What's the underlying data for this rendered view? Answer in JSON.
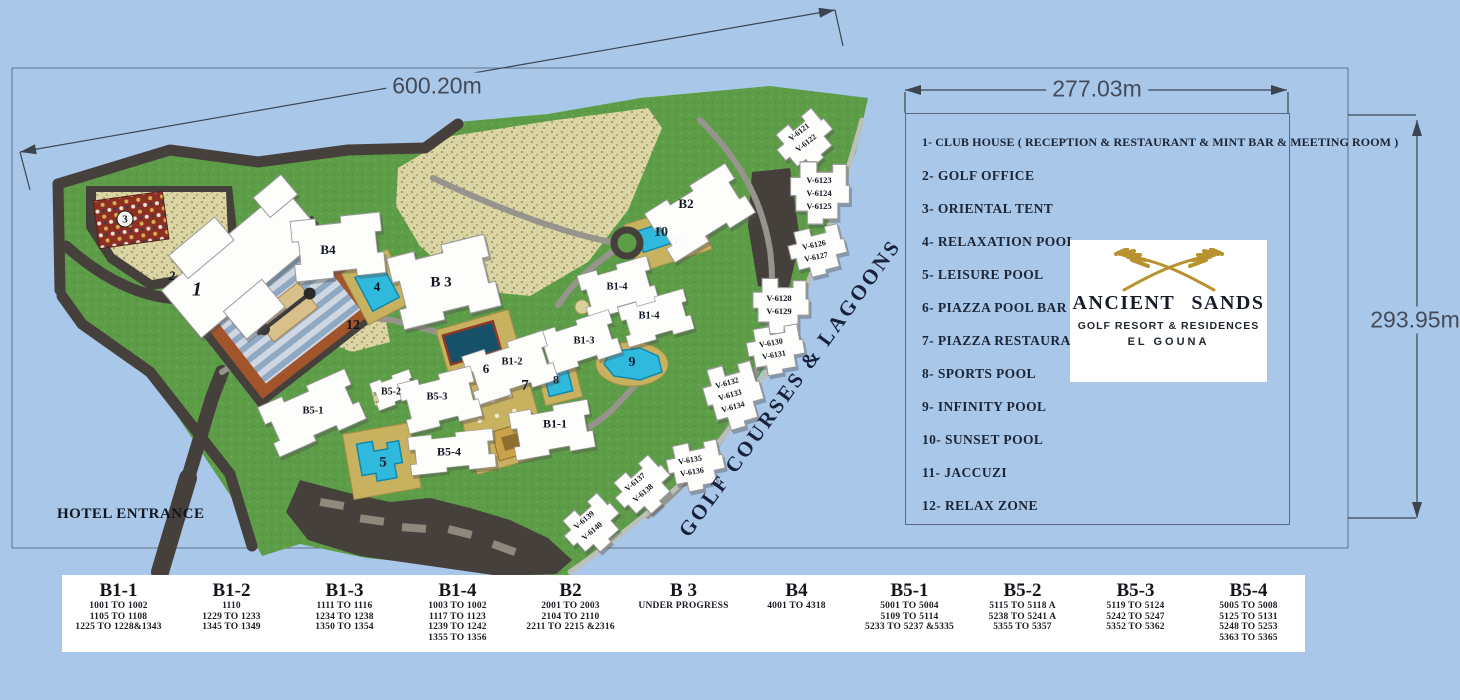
{
  "dimensions": {
    "top": "600.20m",
    "top_right": "277.03m",
    "right": "293.95m"
  },
  "legend": {
    "items": [
      "1- CLUB HOUSE  ( RECEPTION & RESTAURANT & MINT BAR & MEETING ROOM )",
      "2-  GOLF OFFICE",
      "3-  ORIENTAL TENT",
      "4-  RELAXATION POOL",
      "5-  LEISURE POOL",
      "6- PIAZZA POOL BAR",
      "7- PIAZZA RESTAURANT",
      "8- SPORTS POOL",
      "9- INFINITY POOL",
      "10- SUNSET POOL",
      "11- JACCUZI",
      "12- RELAX  ZONE"
    ]
  },
  "logo": {
    "name": "ANCIENT SANDS",
    "subtitle": "GOLF RESORT & RESIDENCES",
    "city": "EL GOUNA"
  },
  "map": {
    "entrance_label": "HOTEL ENTRANCE",
    "water_label": "GOLF COURSES & LAGOONS",
    "labels": [
      {
        "t": "1",
        "x": 197,
        "y": 290,
        "s": 20,
        "i": 1
      },
      {
        "t": "2",
        "x": 172,
        "y": 276,
        "s": 13,
        "i": 1
      },
      {
        "t": "3",
        "x": 125,
        "y": 219,
        "s": 11,
        "circ": 1
      },
      {
        "t": "B4",
        "x": 328,
        "y": 250,
        "s": 13
      },
      {
        "t": "4",
        "x": 377,
        "y": 287,
        "s": 13
      },
      {
        "t": "12",
        "x": 353,
        "y": 326,
        "s": 14
      },
      {
        "t": "B 3",
        "x": 441,
        "y": 283,
        "s": 15
      },
      {
        "t": "B2",
        "x": 686,
        "y": 204,
        "s": 13
      },
      {
        "t": "10",
        "x": 661,
        "y": 233,
        "s": 14,
        "c": "#0e2238"
      },
      {
        "t": "11",
        "x": 678,
        "y": 240,
        "s": 9,
        "c": "#eef6fa"
      },
      {
        "t": "B1-4",
        "x": 617,
        "y": 287,
        "s": 10.5
      },
      {
        "t": "B1-4",
        "x": 649,
        "y": 316,
        "s": 10.5
      },
      {
        "t": "B1-3",
        "x": 584,
        "y": 341,
        "s": 10.5
      },
      {
        "t": "B1-2",
        "x": 512,
        "y": 362,
        "s": 10.5
      },
      {
        "t": "6",
        "x": 486,
        "y": 369,
        "s": 13
      },
      {
        "t": "7",
        "x": 525,
        "y": 386,
        "s": 15
      },
      {
        "t": "8",
        "x": 556,
        "y": 380,
        "s": 12,
        "c": "#0e2238"
      },
      {
        "t": "9",
        "x": 632,
        "y": 363,
        "s": 14,
        "c": "#0e2238"
      },
      {
        "t": "B5-3",
        "x": 437,
        "y": 397,
        "s": 10.5
      },
      {
        "t": "B5-2",
        "x": 391,
        "y": 392,
        "s": 10
      },
      {
        "t": "B5-1",
        "x": 313,
        "y": 411,
        "s": 10.5
      },
      {
        "t": "B1-1",
        "x": 555,
        "y": 424,
        "s": 12
      },
      {
        "t": "B5-4",
        "x": 449,
        "y": 452,
        "s": 12
      },
      {
        "t": "5",
        "x": 383,
        "y": 463,
        "s": 15,
        "c": "#0e2238"
      },
      {
        "t": "V-6121",
        "x": 799,
        "y": 132,
        "s": 8,
        "r": -38
      },
      {
        "t": "V-6122",
        "x": 806,
        "y": 143,
        "s": 8,
        "r": -38
      },
      {
        "t": "V-6123",
        "x": 819,
        "y": 180,
        "s": 8.5
      },
      {
        "t": "V-6124",
        "x": 819,
        "y": 193,
        "s": 8.5
      },
      {
        "t": "V-6125",
        "x": 819,
        "y": 206,
        "s": 8.5
      },
      {
        "t": "V-6126",
        "x": 814,
        "y": 245,
        "s": 8,
        "r": -12
      },
      {
        "t": "V-6127",
        "x": 816,
        "y": 257,
        "s": 8,
        "r": -12
      },
      {
        "t": "V-6128",
        "x": 779,
        "y": 298,
        "s": 8.5
      },
      {
        "t": "V-6129",
        "x": 779,
        "y": 311,
        "s": 8.5
      },
      {
        "t": "V-6130",
        "x": 771,
        "y": 343,
        "s": 8,
        "r": -10
      },
      {
        "t": "V-6131",
        "x": 774,
        "y": 355,
        "s": 8,
        "r": -10
      },
      {
        "t": "V-6132",
        "x": 727,
        "y": 383,
        "s": 8,
        "r": -16
      },
      {
        "t": "V-6133",
        "x": 730,
        "y": 395,
        "s": 8,
        "r": -16
      },
      {
        "t": "V-6134",
        "x": 733,
        "y": 407,
        "s": 8,
        "r": -16
      },
      {
        "t": "V-6135",
        "x": 690,
        "y": 460,
        "s": 8,
        "r": -10
      },
      {
        "t": "V-6136",
        "x": 692,
        "y": 472,
        "s": 8,
        "r": -10
      },
      {
        "t": "V-6137",
        "x": 635,
        "y": 482,
        "s": 8,
        "r": -40
      },
      {
        "t": "V-6138",
        "x": 643,
        "y": 493,
        "s": 8,
        "r": -40
      },
      {
        "t": "V-6139",
        "x": 584,
        "y": 520,
        "s": 8,
        "r": -40
      },
      {
        "t": "V-6140",
        "x": 592,
        "y": 531,
        "s": 8,
        "r": -40
      }
    ]
  },
  "table": {
    "columns": [
      {
        "name": "B1-1",
        "units": [
          "1001 TO 1002",
          "1105 TO 1108",
          "1225 TO 1228&1343"
        ]
      },
      {
        "name": "B1-2",
        "units": [
          "1110",
          "1229 TO 1233",
          "1345 TO 1349"
        ]
      },
      {
        "name": "B1-3",
        "units": [
          "1111 TO 1116",
          "1234 TO 1238",
          "1350 TO 1354"
        ]
      },
      {
        "name": "B1-4",
        "units": [
          "1003 TO 1002",
          "1117 TO 1123",
          "1239 TO 1242",
          "1355 TO 1356"
        ]
      },
      {
        "name": "B2",
        "units": [
          "2001 TO 2003",
          "2104 TO 2110",
          "2211 TO 2215 &2316"
        ]
      },
      {
        "name": "B 3",
        "units": [
          "UNDER PROGRESS"
        ]
      },
      {
        "name": "B4",
        "units": [
          "4001 TO 4318"
        ]
      },
      {
        "name": "B5-1",
        "units": [
          "5001 TO 5004",
          "5109 TO 5114",
          "5233 TO 5237 &5335"
        ]
      },
      {
        "name": "B5-2",
        "units": [
          "5115 TO 5118 A",
          "5238 TO 5241 A",
          "5355 TO 5357"
        ]
      },
      {
        "name": "B5-3",
        "units": [
          "5119 TO 5124",
          "5242 TO 5247",
          "5352 TO 5362"
        ]
      },
      {
        "name": "B5-4",
        "units": [
          "5005 TO 5008",
          "5125 TO 5131",
          "5248 TO 5253",
          "5363 TO 5365"
        ]
      }
    ]
  },
  "colors": {
    "background": "#a9c7e9",
    "grass": "#5e9d47",
    "sand": "#dbd5a6",
    "road": "#46403d",
    "pool": "#2fb9dc",
    "deck": "#c9b25f",
    "gold": "#b8922e",
    "text": "#1c2536"
  }
}
